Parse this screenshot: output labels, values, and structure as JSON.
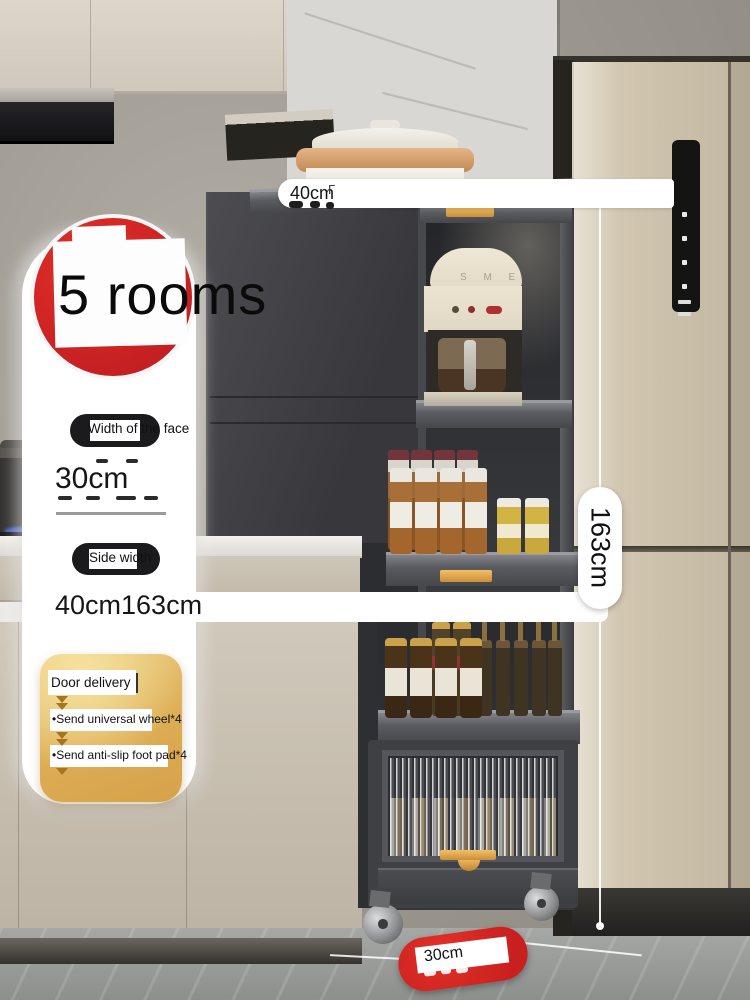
{
  "annotations": {
    "rooms_badge": "5 rooms",
    "top_width": {
      "value": "40cm",
      "mark": "Γ"
    },
    "face_width": {
      "label": "Width of the face",
      "value": "30cm"
    },
    "side_width": {
      "label": "Side width",
      "value": "40cm163cm"
    },
    "height": {
      "value": "163cm"
    },
    "depth": {
      "value": "30cm"
    },
    "promo": {
      "items": [
        "Door delivery",
        "•Send universal wheel*4",
        "•Send anti-slip foot pad*4"
      ]
    }
  },
  "appliance": {
    "coffee_brand": "S M E"
  },
  "colors": {
    "accent_red": "#d42b26",
    "pill_black": "#1b1b1d",
    "promo_gold": "#e2b45e",
    "fridge_beige": "#cdc2ad",
    "rack_charcoal": "#3a3b3f",
    "gold_handle": "#d9a04b"
  }
}
